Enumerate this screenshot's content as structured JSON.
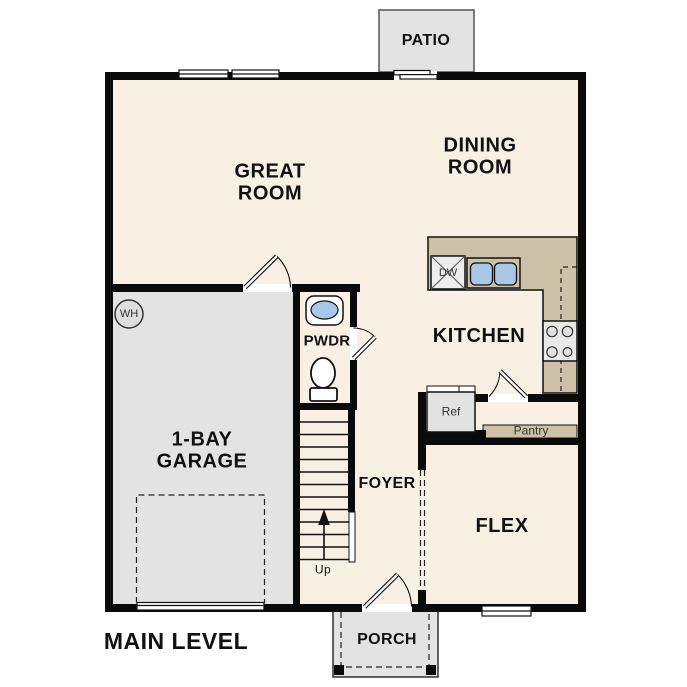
{
  "title": "MAIN LEVEL",
  "rooms": {
    "great_room": "GREAT ROOM",
    "dining_room": "DINING ROOM",
    "kitchen": "KITCHEN",
    "garage": "1-BAY GARAGE",
    "powder": "PWDR",
    "foyer": "FOYER",
    "flex": "FLEX",
    "patio": "PATIO",
    "porch": "PORCH"
  },
  "fixtures": {
    "water_heater": "WH",
    "dishwasher": "DW",
    "refrigerator": "Ref",
    "pantry": "Pantry",
    "stairs_direction": "Up"
  },
  "colors": {
    "floor": "#f8f0e3",
    "counter": "#cdc1a7",
    "garage_floor": "#e3e3e3",
    "outdoor": "#e3e3e3",
    "wall": "#0a0a0a",
    "sink_blue": "#a9c7e7"
  }
}
